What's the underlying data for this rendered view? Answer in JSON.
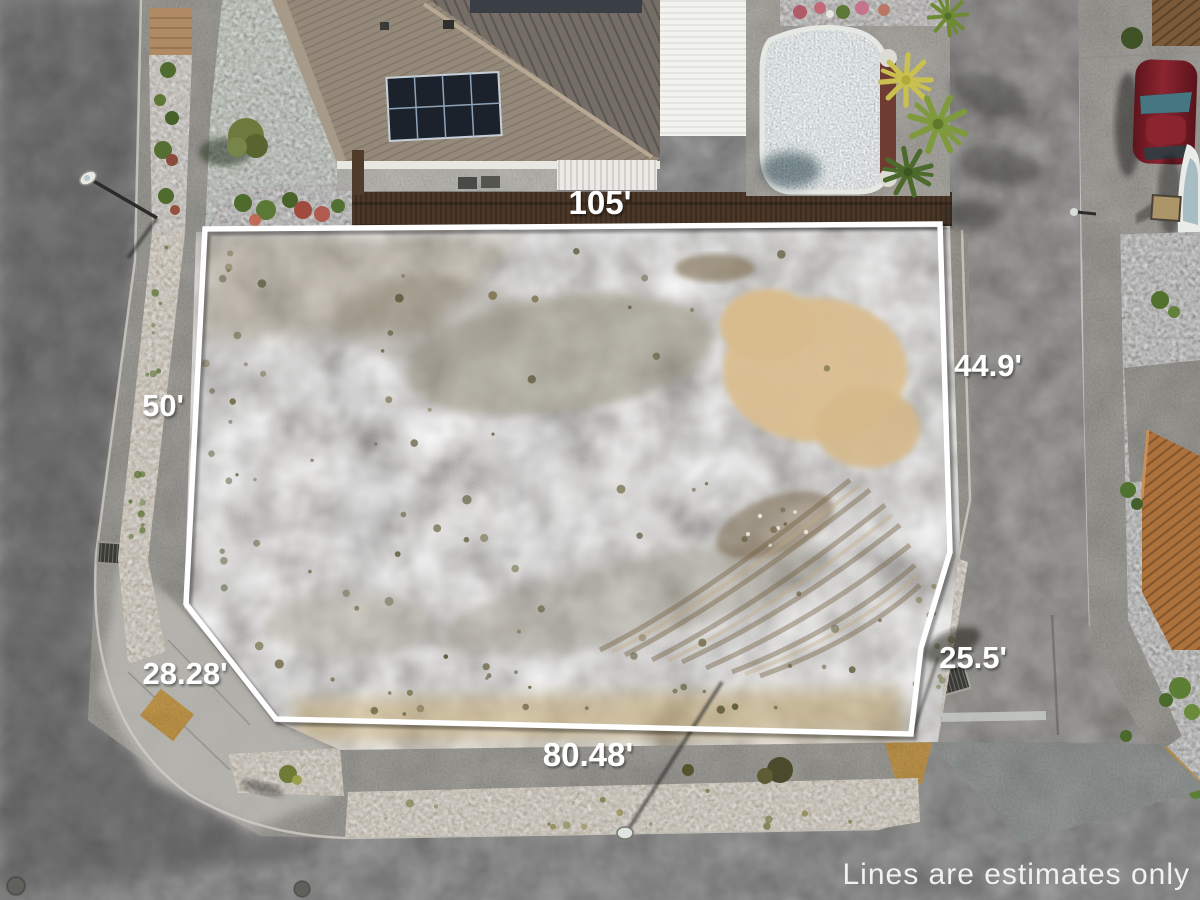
{
  "scene": {
    "title": "Aerial drone photo of vacant corner lot with property line overlay"
  },
  "measurements": {
    "top": "105'",
    "right": "44.9'",
    "left": "50'",
    "bottom": "80.48'",
    "bottom_left_diagonal": "28.28'",
    "bottom_right": "25.5'"
  },
  "disclaimer": "Lines are estimates only",
  "colors": {
    "property_line": "#ffffff",
    "label_text": "#ffffff",
    "tactile_pad_yellow": "#e3b157",
    "pool_water": "#3a7178"
  }
}
